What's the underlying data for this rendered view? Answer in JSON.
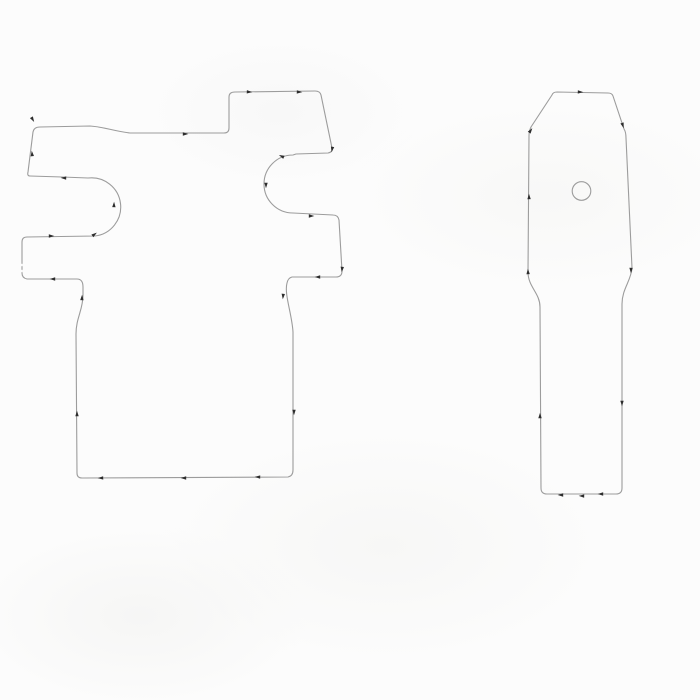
{
  "drawing": {
    "background_color": "#fcfcfc",
    "stroke_color": "#9c9c9c",
    "mark_color": "#2d2d2d",
    "left_template": {
      "path": "M 40 127 L 90 126 C 105 127 113 131 130 133 L 224 133 Q 229 133 229 128 L 229 97 Q 229 92 235 92 L 315 91 Q 320 91 321 95 L 332 148 Q 333 152 328 153 L 296 154 L 293 155 A 29 29 0 0 0 293 213 L 333 215 Q 338 215 339 220 L 342 271 Q 342 277 336 277 L 292 277 Q 288 278 287 283 C 284 294 292 314 293 332 L 293 470 Q 293 476 288 477 L 82 478 Q 77 478 77 473 L 76 334 C 76 318 83 310 83 295 L 83 287 Q 83 279 77 279 L 27 279 Q 22 278 22 273 L 22 242 Q 22 237 27 237 L 95 236 A 29 29 0 0 0 88 178 L 62 177 L 30 176 Q 27 176 28 172 L 33 132 Q 34 127 40 127 Z"
    },
    "right_template": {
      "path": "M 557 92 L 608 93 Q 612 93 613 96 L 624 129 Q 626 132 626 138 L 632 268 C 631 281 622 289 622 304 L 622 488 Q 622 494 616 494 L 547 494 Q 541 494 541 488 L 540 307 C 540 293 528 287 528 272 L 529 136 Q 529 131 531 127 L 552 95 Q 553 92 557 92 Z",
      "hole": {
        "cx": 581.5,
        "cy": 191,
        "r": 9.3
      }
    },
    "marks": [
      {
        "x": 186,
        "y": 134,
        "a": 0
      },
      {
        "x": 250,
        "y": 92,
        "a": 3
      },
      {
        "x": 300,
        "y": 92,
        "a": 2
      },
      {
        "x": 332,
        "y": 150,
        "a": 100
      },
      {
        "x": 281,
        "y": 156,
        "a": 205
      },
      {
        "x": 266,
        "y": 186,
        "a": 90
      },
      {
        "x": 312,
        "y": 216,
        "a": 0
      },
      {
        "x": 342,
        "y": 270,
        "a": 95
      },
      {
        "x": 317,
        "y": 277,
        "a": 180
      },
      {
        "x": 283,
        "y": 297,
        "a": 95
      },
      {
        "x": 294,
        "y": 413,
        "a": 90
      },
      {
        "x": 257,
        "y": 477,
        "a": 182
      },
      {
        "x": 183,
        "y": 478,
        "a": 180
      },
      {
        "x": 100,
        "y": 478,
        "a": 178
      },
      {
        "x": 77,
        "y": 413,
        "a": 270
      },
      {
        "x": 82,
        "y": 297,
        "a": 272
      },
      {
        "x": 52,
        "y": 279,
        "a": 180
      },
      {
        "x": 52,
        "y": 236,
        "a": 0
      },
      {
        "x": 95,
        "y": 234,
        "a": 325
      },
      {
        "x": 114,
        "y": 204,
        "a": 272
      },
      {
        "x": 63,
        "y": 178,
        "a": 182
      },
      {
        "x": 32,
        "y": 153,
        "a": 265
      },
      {
        "x": 33,
        "y": 120,
        "a": 60
      },
      {
        "x": 581,
        "y": 92,
        "a": 2
      },
      {
        "x": 623,
        "y": 126,
        "a": 72
      },
      {
        "x": 631,
        "y": 271,
        "a": 91
      },
      {
        "x": 622,
        "y": 404,
        "a": 90
      },
      {
        "x": 600,
        "y": 494,
        "a": 180
      },
      {
        "x": 581,
        "y": 496,
        "a": 182
      },
      {
        "x": 560,
        "y": 495,
        "a": 180
      },
      {
        "x": 540,
        "y": 415,
        "a": 270
      },
      {
        "x": 528,
        "y": 271,
        "a": 268
      },
      {
        "x": 529,
        "y": 196,
        "a": 269
      },
      {
        "x": 531,
        "y": 130,
        "a": 305
      }
    ],
    "gaps": [
      {
        "x": 21,
        "y": 265
      },
      {
        "x": 21,
        "y": 271
      }
    ]
  }
}
